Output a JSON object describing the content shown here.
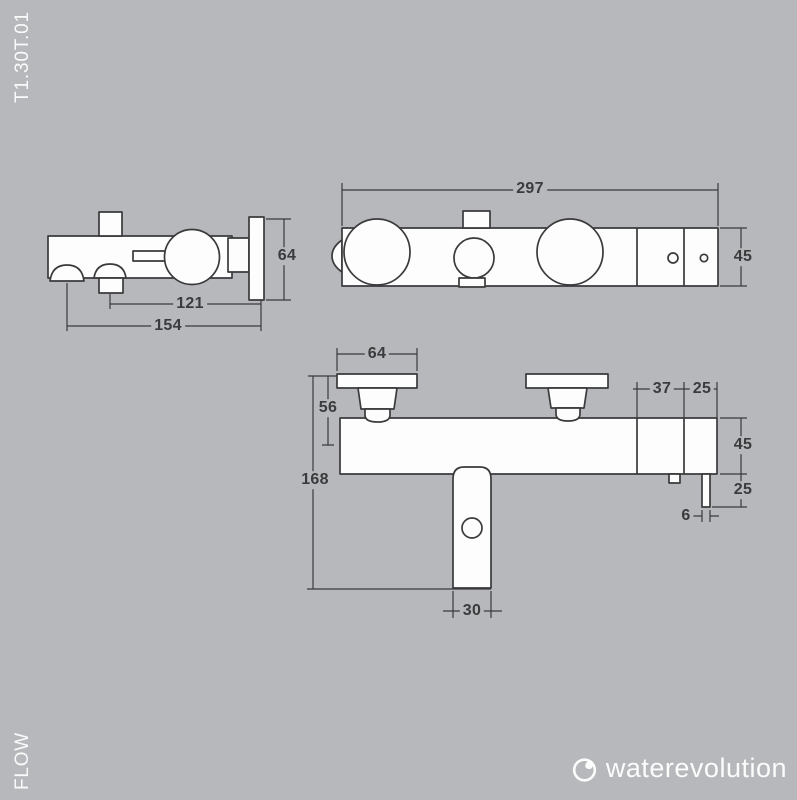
{
  "page": {
    "product_code": "T1.30T.01",
    "collection": "FLOW"
  },
  "brand": {
    "name": "waterevolution"
  },
  "colors": {
    "background": "#b6b8bb",
    "line": "#3a3a3c",
    "shape_fill": "#fdfdfd",
    "dim_text": "#3b3b3d",
    "light_text": "#f5f6f7"
  },
  "views": {
    "side": {
      "label": "side-view",
      "dims": {
        "plate_height": "64",
        "diverter_to_wall": "121",
        "total_depth": "154"
      }
    },
    "top": {
      "label": "top-view",
      "dims": {
        "total_width": "297",
        "body_depth": "45"
      }
    },
    "front": {
      "label": "front-view",
      "dims": {
        "handle_width": "64",
        "handle_height": "56",
        "total_height": "168",
        "panel_width": "37",
        "end_section_width": "25",
        "body_height": "45",
        "outlet_drop": "25",
        "outlet_width": "6",
        "spout_width": "30"
      }
    }
  }
}
